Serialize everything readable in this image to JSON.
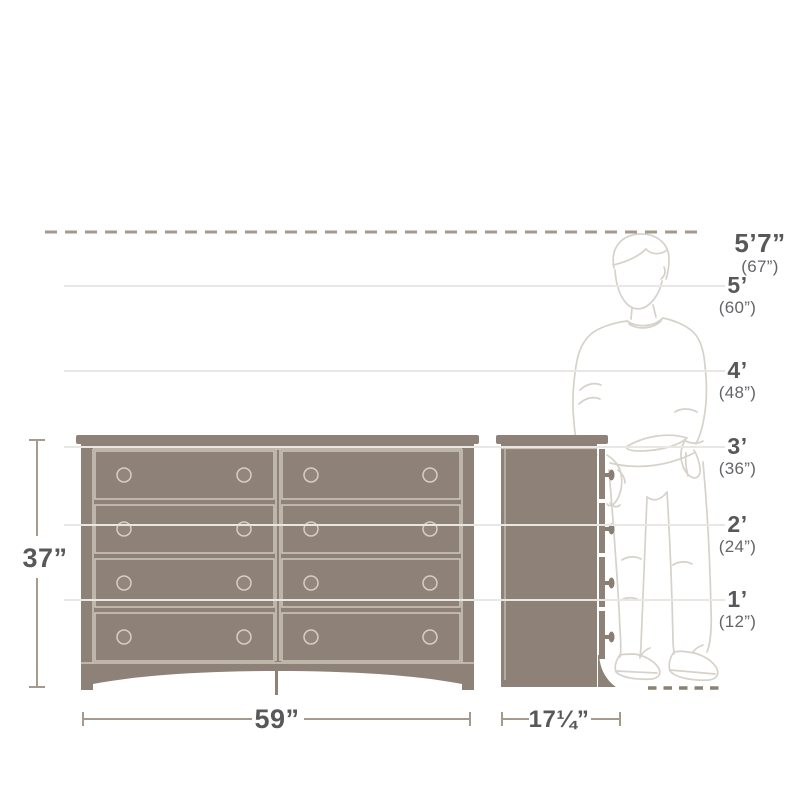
{
  "height_scale": {
    "markers": [
      {
        "id": "5ft7",
        "feet": "5’7”",
        "inches": "(67”)"
      },
      {
        "id": "5ft",
        "feet": "5’",
        "inches": "(60”)"
      },
      {
        "id": "4ft",
        "feet": "4’",
        "inches": "(48”)"
      },
      {
        "id": "3ft",
        "feet": "3’",
        "inches": "(36”)"
      },
      {
        "id": "2ft",
        "feet": "2’",
        "inches": "(24”)"
      },
      {
        "id": "1ft",
        "feet": "1’",
        "inches": "(12”)"
      }
    ]
  },
  "dimensions": {
    "height": "37”",
    "width": "59”",
    "depth": "17¼”"
  },
  "icons": {
    "person": "standing-person-outline",
    "front_view": "dresser-front-view",
    "side_view": "dresser-side-view"
  },
  "colors": {
    "background": "#ffffff",
    "dresser_fill": "#8e8278",
    "dresser_detail": "#cfc7bc",
    "knob_fill": "#93877c",
    "side_knob_fill": "#8a7e73",
    "dimension_line": "#a59a8c",
    "label_text": "#58585b",
    "sub_label_text": "#646569",
    "reference_line": "#e9e7e4",
    "ceiling_dash": "#a49a8c",
    "floor_dash": "#8b8074",
    "person_outline": "#d6d1ca"
  }
}
